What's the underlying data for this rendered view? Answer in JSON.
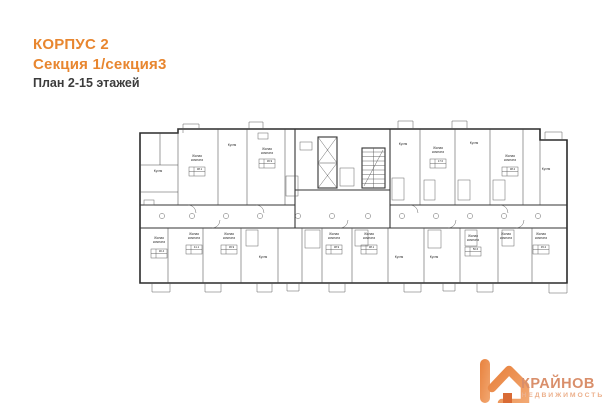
{
  "header": {
    "line1": "КОРПУС 2",
    "line2": "Секция 1/секция3",
    "line3": "План 2-15 этажей"
  },
  "colors": {
    "accent_orange": "#e8862f",
    "heading_dark": "#3c3c3c",
    "plan_line": "#4a4a4a",
    "logo_mark_orange": "#e8823e",
    "logo_name_color": "#d98f6b",
    "logo_subtitle_color": "#ecb08c"
  },
  "logo": {
    "name": "КРАЙНОВ",
    "subtitle": "НЕДВИЖИМОСТЬ",
    "mark": "k-house-icon"
  },
  "plan": {
    "description": "floor-plan-corpus-2-section-1-3",
    "room_labels": [
      {
        "lines": [
          "Кухня"
        ],
        "x": 158,
        "y": 172
      },
      {
        "lines": [
          "Жилая",
          "комната"
        ],
        "x": 197,
        "y": 157
      },
      {
        "lines": [
          "Кухня"
        ],
        "x": 232,
        "y": 146
      },
      {
        "lines": [
          "Жилая",
          "комната"
        ],
        "x": 267,
        "y": 150
      },
      {
        "lines": [
          "Кухня"
        ],
        "x": 403,
        "y": 145
      },
      {
        "lines": [
          "Жилая",
          "комната"
        ],
        "x": 438,
        "y": 149
      },
      {
        "lines": [
          "Кухня"
        ],
        "x": 474,
        "y": 144
      },
      {
        "lines": [
          "Жилая",
          "комната"
        ],
        "x": 510,
        "y": 157
      },
      {
        "lines": [
          "Кухня"
        ],
        "x": 546,
        "y": 170
      },
      {
        "lines": [
          "Жилая",
          "комната"
        ],
        "x": 159,
        "y": 239
      },
      {
        "lines": [
          "Жилая",
          "комната"
        ],
        "x": 194,
        "y": 235
      },
      {
        "lines": [
          "Жилая",
          "комната"
        ],
        "x": 229,
        "y": 235
      },
      {
        "lines": [
          "Кухня"
        ],
        "x": 263,
        "y": 258
      },
      {
        "lines": [
          "Жилая",
          "комната"
        ],
        "x": 334,
        "y": 235
      },
      {
        "lines": [
          "Жилая",
          "комната"
        ],
        "x": 369,
        "y": 235
      },
      {
        "lines": [
          "Кухня"
        ],
        "x": 399,
        "y": 258
      },
      {
        "lines": [
          "Кухня"
        ],
        "x": 434,
        "y": 258
      },
      {
        "lines": [
          "Жилая",
          "комната"
        ],
        "x": 473,
        "y": 237
      },
      {
        "lines": [
          "Жилая",
          "комната"
        ],
        "x": 506,
        "y": 235
      },
      {
        "lines": [
          "Жилая",
          "комната"
        ],
        "x": 541,
        "y": 235
      }
    ],
    "area_tables": [
      {
        "text": "38.1",
        "x": 197,
        "y": 171
      },
      {
        "text": "36.9",
        "x": 267,
        "y": 163
      },
      {
        "text": "17.0",
        "x": 438,
        "y": 163
      },
      {
        "text": "38.2",
        "x": 510,
        "y": 171
      },
      {
        "text": "30.4",
        "x": 159,
        "y": 253
      },
      {
        "text": "41.1",
        "x": 194,
        "y": 249
      },
      {
        "text": "36.9",
        "x": 229,
        "y": 249
      },
      {
        "text": "38.9",
        "x": 334,
        "y": 249
      },
      {
        "text": "38.1",
        "x": 369,
        "y": 249
      },
      {
        "text": "50.6",
        "x": 473,
        "y": 251
      },
      {
        "text": "45.2",
        "x": 541,
        "y": 249
      }
    ]
  }
}
